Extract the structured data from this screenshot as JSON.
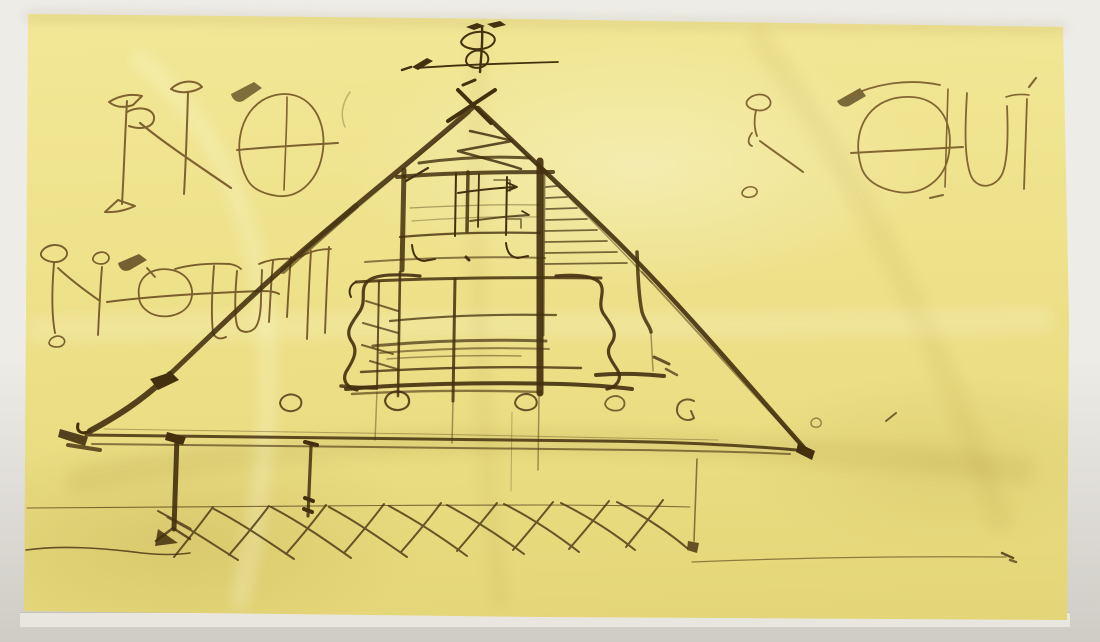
{
  "scene": {
    "title": "Freehand architectural ink sketch on yellow tracing paper",
    "description": "Photograph of a freehand brown-ink section sketch on crumpled yellow tracing paper set in an off-white window mat: a pitched-roof pavilion with upturned eaves, a small roof finial above the ridge, interior timber framing, ogee side brackets, circular column bases, long eaves beams, posts and zig-zag ground cross-hatching, with large stylized pen inscriptions at top left, top right and middle left"
  },
  "colors": {
    "mat_top": "#eeece7",
    "mat_bottom": "#cfccc6",
    "mat_bevel": "#e9e6df",
    "paper": "#ecdf86",
    "paper_light": "#f2e897",
    "paper_dark": "#e3d576",
    "ink": "#43300f",
    "ink_medium": "#6f5022",
    "ink_faint": "#9a8350"
  },
  "inscriptions": {
    "top_left": "illegible stylized pen monogram, reads approximately 'R N O'",
    "top_right": "illegible stylized pen monogram, reads approximately 'R X O U i'",
    "mid_left": "illegible stylized pen monogram, reads approximately 'R i e t u n'"
  },
  "parts": {
    "finial": "roof finial ornament sketched above the ridge",
    "roof": "pitched roof slopes with upturned left eave and long right slope",
    "gable": "gable apex with crossed rafter strokes",
    "attic_frame": "upper-storey timber framing with studs and beams",
    "ladder": "short ladder rungs between post and right roof slope",
    "main_bay": "central bay with ogee side brackets and stacked beams",
    "column_bases": "small circular column bases along the floor beam",
    "eaves_beams": "long horizontal eaves-level beams",
    "posts": "vertical posts running down to the ground",
    "ground_hatching": "repeated zig-zag cross-hatching of the ground",
    "ground_lines": "thin horizontal ground lines",
    "stray_marks": "small stray ink ticks and dots"
  }
}
